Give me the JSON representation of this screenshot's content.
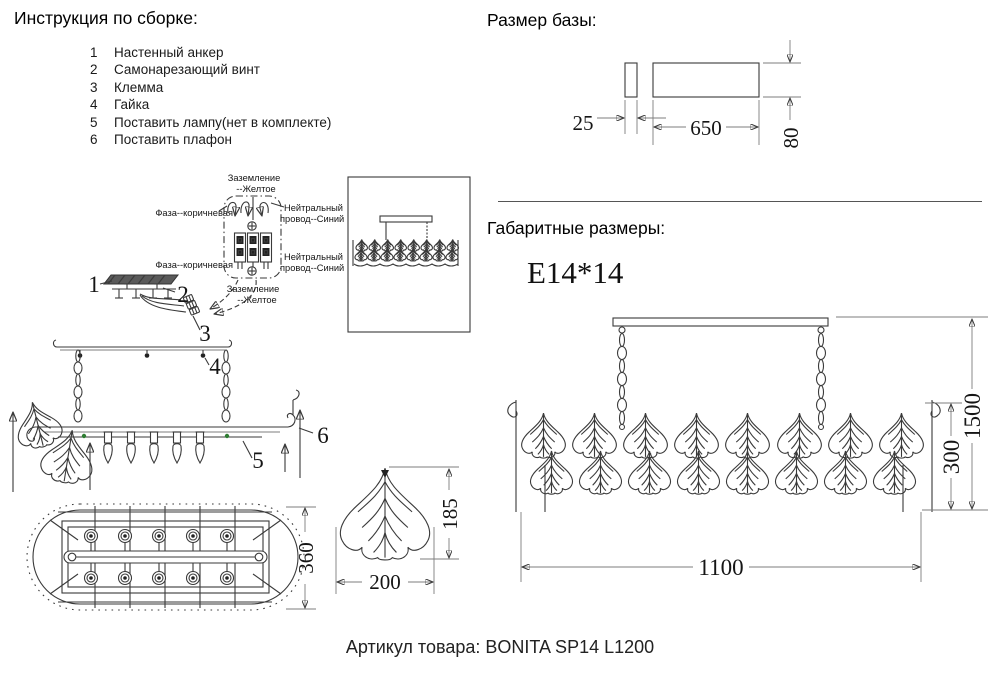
{
  "instructions": {
    "title": "Инструкция по сборке:",
    "items": [
      {
        "num": "1",
        "label": "Настенный анкер"
      },
      {
        "num": "2",
        "label": "Самонарезающий винт"
      },
      {
        "num": "3",
        "label": "Клемма"
      },
      {
        "num": "4",
        "label": "Гайка"
      },
      {
        "num": "5",
        "label": "Поставить лампу(нет в комплекте)"
      },
      {
        "num": "6",
        "label": "Поставить плафон"
      }
    ]
  },
  "wiring": {
    "ground_top_1": "Заземление",
    "ground_top_2": "--Желтое",
    "phase_top": "Фаза--коричневая",
    "neutral_top_1": "Нейтральный",
    "neutral_top_2": "провод--Синий",
    "phase_bottom": "Фаза--коричневая",
    "neutral_bottom_1": "Нейтральный",
    "neutral_bottom_2": "провод--Синий",
    "ground_bottom_1": "Заземление",
    "ground_bottom_2": "--Желтое"
  },
  "callouts": {
    "n1": "1",
    "n2": "2",
    "n3": "3",
    "n4": "4",
    "n5": "5",
    "n6": "6"
  },
  "base_size": {
    "title": "Размер базы:",
    "width_small": "25",
    "width_large": "650",
    "height": "80"
  },
  "overall": {
    "title": "Габаритные размеры:",
    "socket": "E14*14",
    "height_total": "1500",
    "body_height": "300",
    "body_width": "1100"
  },
  "views": {
    "top_width": "360",
    "shade_height": "185",
    "shade_width": "200"
  },
  "footer": {
    "article": "Артикул товара: BONITA SP14 L1200"
  },
  "colors": {
    "line": "#3a3a3a",
    "dim": "#7d7d7d",
    "accent_green": "#2e7d32"
  }
}
